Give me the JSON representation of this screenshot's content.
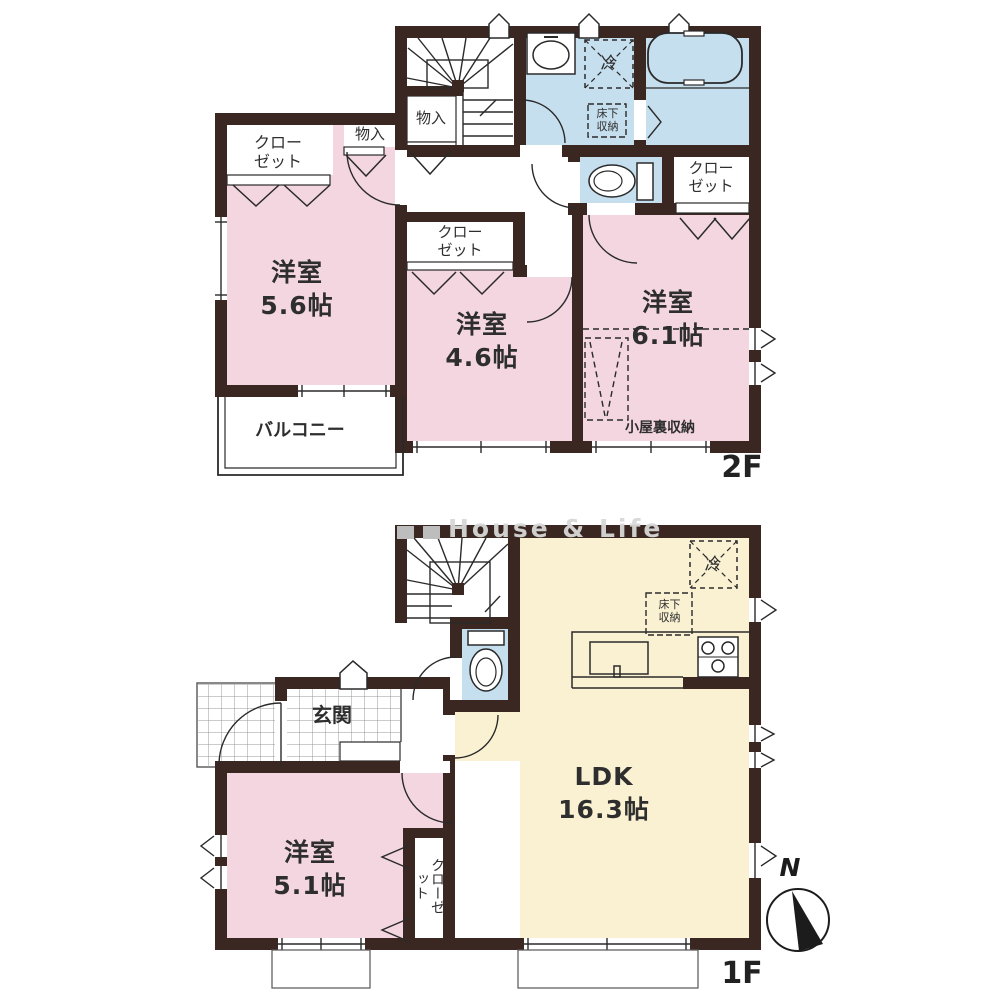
{
  "watermark": "House & Life",
  "compass": {
    "north": "N"
  },
  "colors": {
    "wall": "#3a2721",
    "bedroom_pink": "#f3d6e0",
    "wet_blue": "#c6dfee",
    "ldk_cream": "#faf1d3",
    "line": "#2a2a2a"
  },
  "floors": {
    "f2": {
      "label": "2F",
      "rooms": {
        "bedroom56": {
          "name": "洋室",
          "area": "5.6帖"
        },
        "bedroom46": {
          "name": "洋室",
          "area": "4.6帖"
        },
        "bedroom61": {
          "name": "洋室",
          "area": "6.1帖"
        },
        "closet_nw": {
          "label": "クローゼット"
        },
        "closet_mid": {
          "label": "クローゼット"
        },
        "closet_east": {
          "label": "クローゼット"
        },
        "storage1": {
          "label": "物入"
        },
        "storage2": {
          "label": "物入"
        },
        "fridge": {
          "label": "冷"
        },
        "underfloor": {
          "label": "床下収納"
        },
        "attic": {
          "label": "小屋裏収納"
        },
        "balcony": {
          "label": "バルコニー"
        }
      }
    },
    "f1": {
      "label": "1F",
      "rooms": {
        "ldk": {
          "name": "LDK",
          "area": "16.3帖"
        },
        "bedroom51": {
          "name": "洋室",
          "area": "5.1帖"
        },
        "entrance": {
          "label": "玄関"
        },
        "closet": {
          "label": "クローゼット"
        },
        "fridge": {
          "label": "冷"
        },
        "underfloor": {
          "label": "床下収納"
        }
      }
    }
  }
}
